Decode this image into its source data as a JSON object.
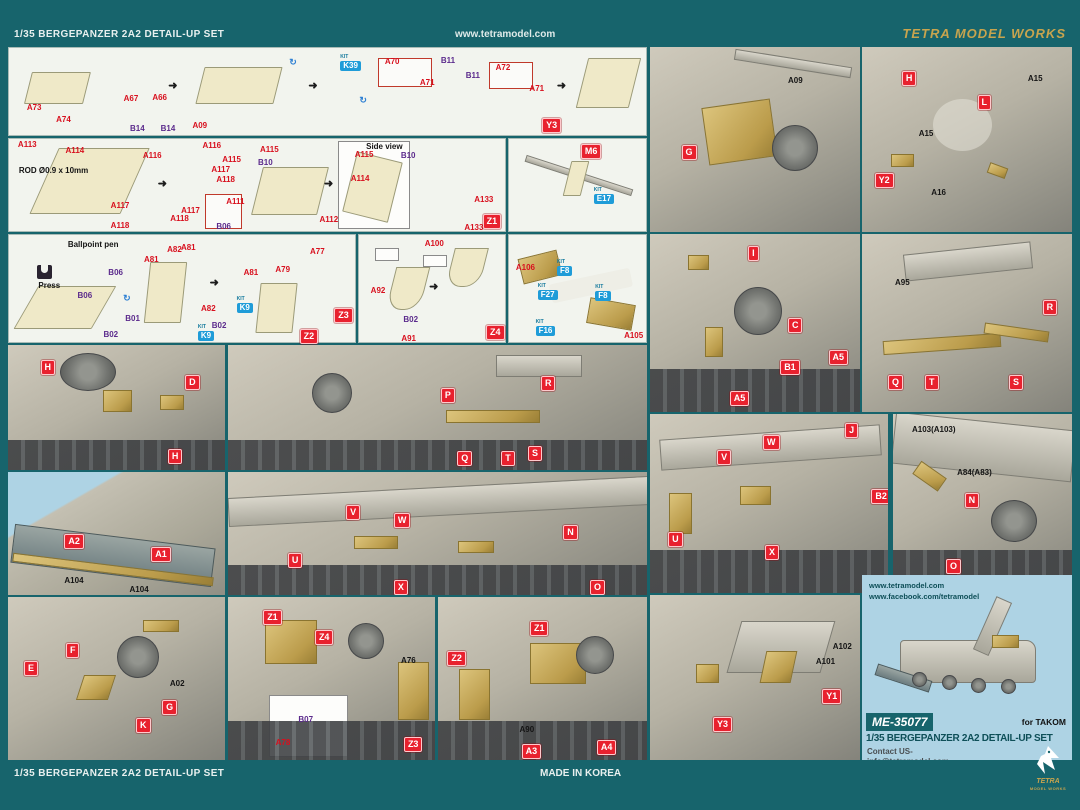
{
  "kit_tag": "KIT",
  "header": {
    "left": "1/35 BERGEPANZER 2A2 DETAIL-UP SET",
    "center": "www.tetramodel.com",
    "right": "TETRA MODEL WORKS"
  },
  "footer": {
    "left": "1/35 BERGEPANZER 2A2 DETAIL-UP SET",
    "center": "MADE IN KOREA",
    "logo_text": "TETRA",
    "logo_sub": "MODEL WORKS"
  },
  "info": {
    "url1": "www.tetramodel.com",
    "url2": "www.facebook.com/tetramodel",
    "sku": "ME-35077",
    "for_text": "for TAKOM",
    "title": "1/35 BERGEPANZER 2A2 DETAIL-UP SET",
    "contact1": "Contact US-",
    "contact2": "info@tetramodel.com"
  },
  "colors": {
    "teal": "#17646c",
    "red": "#e8212e",
    "blue": "#1f9cd8",
    "gold": "#c8a44e",
    "brass": "#c2a95e",
    "photo_blue": "#aed3e4"
  },
  "panels": {
    "p1": {
      "labels": [
        {
          "t": "A73",
          "k": "red",
          "x": 2.8,
          "y": 64
        },
        {
          "t": "A74",
          "k": "red",
          "x": 7.4,
          "y": 78
        },
        {
          "t": "A67",
          "k": "red",
          "x": 18,
          "y": 54
        },
        {
          "t": "A66",
          "k": "red",
          "x": 22.5,
          "y": 53
        },
        {
          "t": "B14",
          "k": "purple",
          "x": 19,
          "y": 88
        },
        {
          "t": "B14",
          "k": "purple",
          "x": 23.8,
          "y": 89
        },
        {
          "t": "A09",
          "k": "red",
          "x": 28.8,
          "y": 85
        },
        {
          "t": "K39",
          "k": "blue",
          "x": 52,
          "y": 15
        },
        {
          "t": "A70",
          "k": "red",
          "x": 59,
          "y": 12
        },
        {
          "t": "A71",
          "k": "red",
          "x": 64.5,
          "y": 36
        },
        {
          "t": "B11",
          "k": "purple",
          "x": 67.8,
          "y": 10
        },
        {
          "t": "B11",
          "k": "purple",
          "x": 71.7,
          "y": 28
        },
        {
          "t": "A72",
          "k": "red",
          "x": 76.4,
          "y": 18
        },
        {
          "t": "A71",
          "k": "red",
          "x": 81.7,
          "y": 43
        },
        {
          "t": "Y3",
          "k": "box",
          "x": 83.7,
          "y": 80
        }
      ]
    },
    "p2": {
      "labels": [
        {
          "t": "A09",
          "k": "black",
          "x": 65.7,
          "y": 16
        },
        {
          "t": "G",
          "k": "box",
          "x": 15,
          "y": 53
        }
      ]
    },
    "p3": {
      "labels": [
        {
          "t": "H",
          "k": "box",
          "x": 19,
          "y": 13
        },
        {
          "t": "L",
          "k": "box",
          "x": 55,
          "y": 26
        },
        {
          "t": "A15",
          "k": "black",
          "x": 79,
          "y": 15
        },
        {
          "t": "A15",
          "k": "black",
          "x": 27,
          "y": 45
        },
        {
          "t": "Y2",
          "k": "box",
          "x": 6,
          "y": 68
        },
        {
          "t": "A16",
          "k": "black",
          "x": 33,
          "y": 77
        }
      ]
    },
    "p4": {
      "labels": [
        {
          "t": "A113",
          "k": "red",
          "x": 1.8,
          "y": 2
        },
        {
          "t": "ROD Ø0.9 x 10mm",
          "k": "note",
          "x": 2,
          "y": 30
        },
        {
          "t": "A114",
          "k": "red",
          "x": 11.4,
          "y": 8.5
        },
        {
          "t": "A116",
          "k": "red",
          "x": 27,
          "y": 14
        },
        {
          "t": "A116",
          "k": "red",
          "x": 39,
          "y": 3
        },
        {
          "t": "A115",
          "k": "red",
          "x": 43,
          "y": 19
        },
        {
          "t": "A117",
          "k": "red",
          "x": 40.8,
          "y": 29
        },
        {
          "t": "A118",
          "k": "red",
          "x": 41.8,
          "y": 40
        },
        {
          "t": "A117",
          "k": "red",
          "x": 20.5,
          "y": 69
        },
        {
          "t": "A118",
          "k": "red",
          "x": 20.5,
          "y": 90
        },
        {
          "t": "A117",
          "k": "red",
          "x": 34.7,
          "y": 74
        },
        {
          "t": "A118",
          "k": "red",
          "x": 32.5,
          "y": 83
        },
        {
          "t": "A111",
          "k": "red",
          "x": 43.8,
          "y": 64
        },
        {
          "t": "B06",
          "k": "purple",
          "x": 41.8,
          "y": 91
        },
        {
          "t": "A115",
          "k": "red",
          "x": 50.6,
          "y": 8
        },
        {
          "t": "B10",
          "k": "purple",
          "x": 50.2,
          "y": 22
        },
        {
          "t": "A112",
          "k": "red",
          "x": 62.6,
          "y": 84
        },
        {
          "t": "Side view",
          "k": "note",
          "x": 72,
          "y": 4
        },
        {
          "t": "A115",
          "k": "red",
          "x": 69.7,
          "y": 13
        },
        {
          "t": "B10",
          "k": "purple",
          "x": 79,
          "y": 14
        },
        {
          "t": "A114",
          "k": "red",
          "x": 68.9,
          "y": 39
        },
        {
          "t": "A133",
          "k": "red",
          "x": 93.8,
          "y": 62
        },
        {
          "t": "A133",
          "k": "red",
          "x": 91.8,
          "y": 92
        },
        {
          "t": "Z1",
          "k": "box",
          "x": 95.5,
          "y": 82
        }
      ]
    },
    "p5": {
      "labels": [
        {
          "t": "M6",
          "k": "box",
          "x": 52.5,
          "y": 5
        },
        {
          "t": "E17",
          "k": "blue",
          "x": 61.9,
          "y": 60
        }
      ]
    },
    "p6": {
      "labels": [
        {
          "t": "Ballpoint pen",
          "k": "note",
          "x": 17,
          "y": 6
        },
        {
          "t": "Press",
          "k": "note",
          "x": 8.5,
          "y": 44
        },
        {
          "t": "B06",
          "k": "purple",
          "x": 28.7,
          "y": 32
        },
        {
          "t": "B06",
          "k": "purple",
          "x": 19.8,
          "y": 53
        },
        {
          "t": "B01",
          "k": "purple",
          "x": 33.6,
          "y": 75
        },
        {
          "t": "B02",
          "k": "purple",
          "x": 27.3,
          "y": 90
        },
        {
          "t": "A81",
          "k": "red",
          "x": 39,
          "y": 20
        },
        {
          "t": "A82",
          "k": "red",
          "x": 45.7,
          "y": 10
        },
        {
          "t": "A81",
          "k": "red",
          "x": 49.7,
          "y": 8
        },
        {
          "t": "A81",
          "k": "red",
          "x": 67.8,
          "y": 32
        },
        {
          "t": "A82",
          "k": "red",
          "x": 55.5,
          "y": 65
        },
        {
          "t": "B02",
          "k": "purple",
          "x": 58.6,
          "y": 81
        },
        {
          "t": "K9",
          "k": "blue",
          "x": 65.8,
          "y": 64
        },
        {
          "t": "K9",
          "k": "blue",
          "x": 54.6,
          "y": 90
        },
        {
          "t": "A79",
          "k": "red",
          "x": 77,
          "y": 29
        },
        {
          "t": "A77",
          "k": "red",
          "x": 87,
          "y": 12
        },
        {
          "t": "Z2",
          "k": "box",
          "x": 84,
          "y": 88
        },
        {
          "t": "Z3",
          "k": "box",
          "x": 94,
          "y": 68
        }
      ]
    },
    "p7": {
      "labels": [
        {
          "t": "A100",
          "k": "red",
          "x": 45,
          "y": 5
        },
        {
          "t": "A92",
          "k": "red",
          "x": 8,
          "y": 49
        },
        {
          "t": "B02",
          "k": "purple",
          "x": 30.4,
          "y": 76
        },
        {
          "t": "A91",
          "k": "red",
          "x": 29,
          "y": 93
        },
        {
          "t": "Z4",
          "k": "box",
          "x": 87,
          "y": 84
        }
      ]
    },
    "p8": {
      "labels": [
        {
          "t": "A106",
          "k": "red",
          "x": 5,
          "y": 27
        },
        {
          "t": "F8",
          "k": "blue",
          "x": 35,
          "y": 29
        },
        {
          "t": "F27",
          "k": "blue",
          "x": 21,
          "y": 51
        },
        {
          "t": "F8",
          "k": "blue",
          "x": 63,
          "y": 52
        },
        {
          "t": "F16",
          "k": "blue",
          "x": 19.4,
          "y": 85
        },
        {
          "t": "A105",
          "k": "red",
          "x": 84,
          "y": 91
        }
      ]
    },
    "p9": {
      "labels": [
        {
          "t": "I",
          "k": "box",
          "x": 46.7,
          "y": 7
        },
        {
          "t": "C",
          "k": "box",
          "x": 65.7,
          "y": 47
        },
        {
          "t": "B1",
          "k": "box",
          "x": 62,
          "y": 71
        },
        {
          "t": "A5",
          "k": "box",
          "x": 85,
          "y": 65
        },
        {
          "t": "A5",
          "k": "box",
          "x": 38,
          "y": 88
        }
      ]
    },
    "p10": {
      "labels": [
        {
          "t": "A95",
          "k": "black",
          "x": 15.7,
          "y": 25
        },
        {
          "t": "R",
          "k": "box",
          "x": 86,
          "y": 37
        },
        {
          "t": "Q",
          "k": "box",
          "x": 12.4,
          "y": 79
        },
        {
          "t": "T",
          "k": "box",
          "x": 30,
          "y": 79
        },
        {
          "t": "S",
          "k": "box",
          "x": 70,
          "y": 79
        }
      ]
    },
    "p11": {
      "labels": [
        {
          "t": "H",
          "k": "box",
          "x": 15,
          "y": 12
        },
        {
          "t": "D",
          "k": "box",
          "x": 81.6,
          "y": 24
        },
        {
          "t": "H",
          "k": "box",
          "x": 73.7,
          "y": 83
        }
      ]
    },
    "p12": {
      "labels": [
        {
          "t": "A2",
          "k": "box",
          "x": 26,
          "y": 50
        },
        {
          "t": "A1",
          "k": "box",
          "x": 66,
          "y": 61
        },
        {
          "t": "A104",
          "k": "black",
          "x": 26,
          "y": 85
        },
        {
          "t": "A104",
          "k": "black",
          "x": 56,
          "y": 93
        }
      ]
    },
    "p13": {
      "labels": [
        {
          "t": "P",
          "k": "box",
          "x": 50.8,
          "y": 34
        },
        {
          "t": "R",
          "k": "box",
          "x": 74.7,
          "y": 25
        },
        {
          "t": "Q",
          "k": "box",
          "x": 54.7,
          "y": 85
        },
        {
          "t": "T",
          "k": "box",
          "x": 65.2,
          "y": 85
        },
        {
          "t": "S",
          "k": "box",
          "x": 71.6,
          "y": 81
        }
      ]
    },
    "p14": {
      "labels": [
        {
          "t": "V",
          "k": "box",
          "x": 28.2,
          "y": 27
        },
        {
          "t": "W",
          "k": "box",
          "x": 39.6,
          "y": 33
        },
        {
          "t": "U",
          "k": "box",
          "x": 14.3,
          "y": 66
        },
        {
          "t": "X",
          "k": "box",
          "x": 39.6,
          "y": 88
        },
        {
          "t": "N",
          "k": "box",
          "x": 80,
          "y": 43
        },
        {
          "t": "O",
          "k": "box",
          "x": 86.4,
          "y": 88
        }
      ]
    },
    "p15": {
      "labels": [
        {
          "t": "J",
          "k": "box",
          "x": 82,
          "y": 5
        },
        {
          "t": "W",
          "k": "box",
          "x": 47.5,
          "y": 12
        },
        {
          "t": "V",
          "k": "box",
          "x": 28.2,
          "y": 20
        },
        {
          "t": "B2",
          "k": "box",
          "x": 93,
          "y": 42
        },
        {
          "t": "U",
          "k": "box",
          "x": 7.6,
          "y": 66
        },
        {
          "t": "X",
          "k": "box",
          "x": 48.3,
          "y": 73
        }
      ]
    },
    "p16": {
      "labels": [
        {
          "t": "A103(A103)",
          "k": "black",
          "x": 10.6,
          "y": 6.7
        },
        {
          "t": "A84(A83)",
          "k": "black",
          "x": 35.8,
          "y": 30.7
        },
        {
          "t": "N",
          "k": "box",
          "x": 40,
          "y": 44
        },
        {
          "t": "O",
          "k": "box",
          "x": 29.6,
          "y": 81
        }
      ]
    },
    "p17": {
      "labels": [
        {
          "t": "E",
          "k": "box",
          "x": 7.4,
          "y": 39
        },
        {
          "t": "F",
          "k": "box",
          "x": 26.7,
          "y": 28
        },
        {
          "t": "K",
          "k": "box",
          "x": 59,
          "y": 74
        },
        {
          "t": "G",
          "k": "box",
          "x": 71,
          "y": 63
        },
        {
          "t": "A02",
          "k": "black",
          "x": 74.6,
          "y": 51
        }
      ]
    },
    "p18": {
      "labels": [
        {
          "t": "Z1",
          "k": "box",
          "x": 17,
          "y": 8
        },
        {
          "t": "Z4",
          "k": "box",
          "x": 42,
          "y": 20
        },
        {
          "t": "A76",
          "k": "black",
          "x": 83.6,
          "y": 37
        },
        {
          "t": "B07",
          "k": "purple",
          "x": 34,
          "y": 73
        },
        {
          "t": "A78",
          "k": "red",
          "x": 23,
          "y": 87
        },
        {
          "t": "Z3",
          "k": "box",
          "x": 85,
          "y": 86
        }
      ]
    },
    "p19": {
      "labels": [
        {
          "t": "Z2",
          "k": "box",
          "x": 4.5,
          "y": 33
        },
        {
          "t": "Z1",
          "k": "box",
          "x": 44,
          "y": 15
        },
        {
          "t": "A90",
          "k": "black",
          "x": 39,
          "y": 79
        },
        {
          "t": "A3",
          "k": "box",
          "x": 40,
          "y": 90
        },
        {
          "t": "A4",
          "k": "box",
          "x": 76,
          "y": 88
        }
      ]
    },
    "p20": {
      "labels": [
        {
          "t": "Y3",
          "k": "box",
          "x": 30,
          "y": 74
        },
        {
          "t": "Y1",
          "k": "box",
          "x": 82,
          "y": 57
        },
        {
          "t": "A102",
          "k": "black",
          "x": 87,
          "y": 29
        },
        {
          "t": "A101",
          "k": "black",
          "x": 79,
          "y": 38
        }
      ]
    }
  }
}
